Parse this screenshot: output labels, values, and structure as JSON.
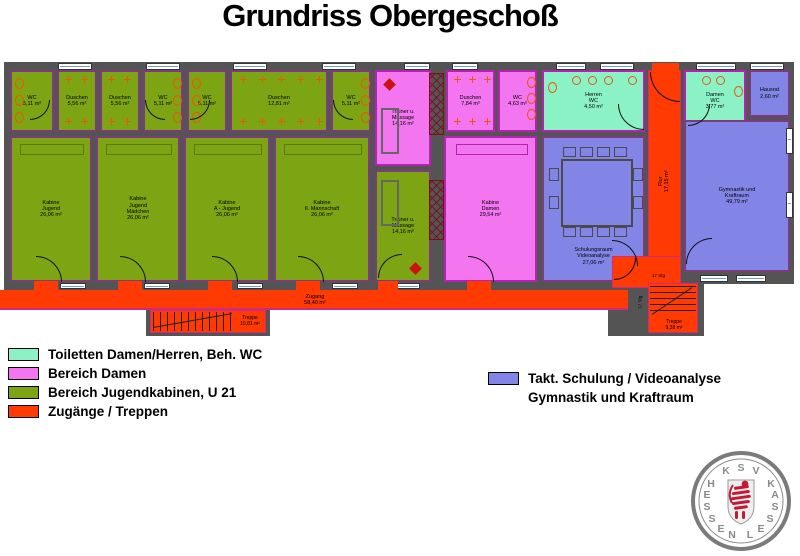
{
  "title": "Grundriss Obergeschoß",
  "rooms": [
    {
      "id": "wc-1",
      "label": "WC\n5,11 m²"
    },
    {
      "id": "duschen-1",
      "label": "Duschen\n5,56 m²"
    },
    {
      "id": "duschen-2",
      "label": "Duschen\n5,56 m²"
    },
    {
      "id": "wc-2",
      "label": "WC\n5,11 m²"
    },
    {
      "id": "wc-3",
      "label": "WC\n5,11 m²"
    },
    {
      "id": "duschen-3",
      "label": "Duschen\n12,81 m²"
    },
    {
      "id": "wc-4",
      "label": "WC\n5,11 m²"
    },
    {
      "id": "kabine-jugend-1",
      "label": "Kabine\nJugend\n26,06 m²"
    },
    {
      "id": "kabine-jugend-maedchen",
      "label": "Kabine\nJugend\nMädchen\n26,06 m²"
    },
    {
      "id": "kabine-a-jugend",
      "label": "Kabine\nA - Jugend\n26,06 m²"
    },
    {
      "id": "kabine-ii-mannschaft",
      "label": "Kabine\nII. Mannschaft\n26,06 m²"
    },
    {
      "id": "trainer-massage-1",
      "label": "Trainer u.\nMassage\n14,16 m²"
    },
    {
      "id": "duschen-damen",
      "label": "Duschen\n7,84 m²"
    },
    {
      "id": "wc-damen",
      "label": "WC\n4,63 m²"
    },
    {
      "id": "kabine-damen",
      "label": "Kabine\nDamen\n29,54 m²"
    },
    {
      "id": "trainer-massage-2",
      "label": "Trainer u.\nMassage\n14,16 m²"
    },
    {
      "id": "herren-wc",
      "label": "Herren\nWC\n4,50 m²"
    },
    {
      "id": "damen-wc",
      "label": "Damen\nWC\n3,77 m²"
    },
    {
      "id": "hausrat",
      "label": "Hausrat\n2,60 m²"
    },
    {
      "id": "schulungsraum",
      "label": "Schulungsraum\nVideoanalyse\n27,06 m²"
    },
    {
      "id": "gymnastik",
      "label": "Gymnastik und\nKraftraum\n49,79 m²"
    }
  ],
  "circulation": {
    "flur": "Flur\n17,15 m²",
    "zugang": "Zugang\n58,40 m²",
    "treppe_left": "Treppe\n10,81 m²",
    "treppe_right": "Treppe\n9,38 m²",
    "stair_note": "17 Stg"
  },
  "legend": {
    "items": [
      {
        "label": "Toiletten Damen/Herren, Beh. WC",
        "color": "#8BF2C5"
      },
      {
        "label": "Bereich Damen",
        "color": "#F375EF"
      },
      {
        "label": "Bereich Jugendkabinen, U 21",
        "color": "#7CA413"
      },
      {
        "label": "Zugänge / Treppen",
        "color": "#FF3A02"
      }
    ],
    "right": {
      "color": "#8285E6",
      "line1": "Takt. Schulung / Videoanalyse",
      "line2": "Gymnastik und Kraftraum"
    }
  },
  "logo": {
    "ksv": [
      "K",
      "S",
      "V"
    ],
    "hessen": [
      "H",
      "E",
      "S",
      "S",
      "E",
      "N"
    ],
    "kassel": [
      "K",
      "A",
      "S",
      "S",
      "E",
      "L"
    ]
  },
  "colors": {
    "youth_area": "#7CA413",
    "damen_area": "#F375EF",
    "toilet_area": "#8BF2C5",
    "training_area": "#8285E6",
    "access_area": "#FF3A02",
    "walls": "#545454"
  }
}
